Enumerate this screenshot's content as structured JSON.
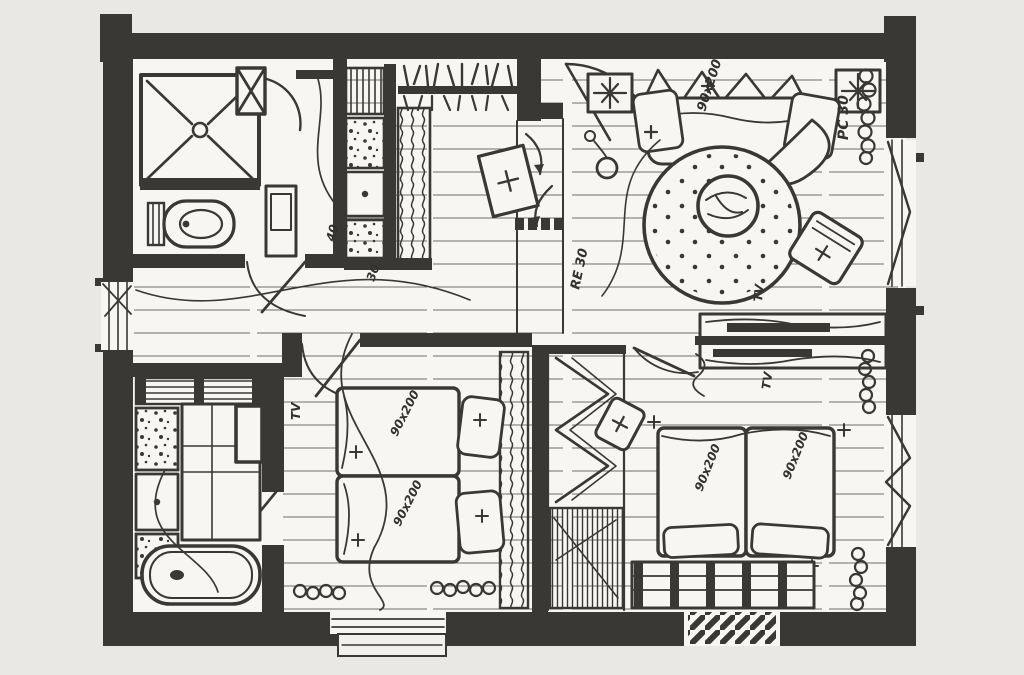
{
  "document": {
    "title": "Hand-drawn apartment floor plan sketch",
    "style": "black ink sketch on light grey paper"
  },
  "palette": {
    "paper": "#e9e8e5",
    "floor": "#f7f6f3",
    "ink": "#3a3834",
    "ink_light": "#6e6c66"
  },
  "rooms": {
    "bathroom_top": {
      "name": "shower bathroom",
      "furniture": [
        "shower",
        "toilet",
        "washbasin",
        "vent-shaft"
      ]
    },
    "kitchen": {
      "name": "kitchen",
      "furniture": [
        "upper-shelves-with-dishes",
        "appliance-column",
        "tall-cabinet",
        "counter"
      ]
    },
    "entry": {
      "name": "entry",
      "furniture": [
        "entry-door",
        "leaning-picture-frame",
        "threshold-dashes"
      ]
    },
    "living_room": {
      "name": "living room",
      "furniture": [
        "sofa",
        "round-rug",
        "coffee-table",
        "armchair",
        "ceiling-lights",
        "pendant-lamp",
        "radiator",
        "window"
      ]
    },
    "bathroom_bottom": {
      "name": "bathtub bathroom",
      "furniture": [
        "bathtub",
        "vanity-counter",
        "sink",
        "cabinets",
        "bench"
      ]
    },
    "bedroom_middle": {
      "name": "bedroom 1",
      "furniture": [
        "double-bed",
        "pillows",
        "curtain-wardrobe",
        "radiators",
        "window"
      ]
    },
    "bedroom_right": {
      "name": "bedroom 2",
      "furniture": [
        "double-bed",
        "pillows",
        "headboard-bench",
        "stool",
        "radiators",
        "window",
        "doormat"
      ]
    },
    "tv_console": {
      "name": "double-sided tv sideboard"
    },
    "closet": {
      "name": "closet niche"
    }
  },
  "annotations": [
    {
      "text": "90x200",
      "area": "sofa"
    },
    {
      "text": "PC 30",
      "area": "living-room-right-wall"
    },
    {
      "text": "RE 30",
      "area": "living-room-floor"
    },
    {
      "text": "TV",
      "area": "tv-console-living-side"
    },
    {
      "text": "TV",
      "area": "tv-console-bedroom-side"
    },
    {
      "text": "TV",
      "area": "bedroom-1-left-wall"
    },
    {
      "text": "90x200",
      "area": "bedroom-1-mattress-upper"
    },
    {
      "text": "90x200",
      "area": "bedroom-1-mattress-lower"
    },
    {
      "text": "90x200",
      "area": "bedroom-2-mattress-left"
    },
    {
      "text": "90x200",
      "area": "bedroom-2-mattress-right"
    },
    {
      "text": "40",
      "area": "kitchen-counter"
    },
    {
      "text": "30",
      "area": "kitchen-floor"
    }
  ]
}
